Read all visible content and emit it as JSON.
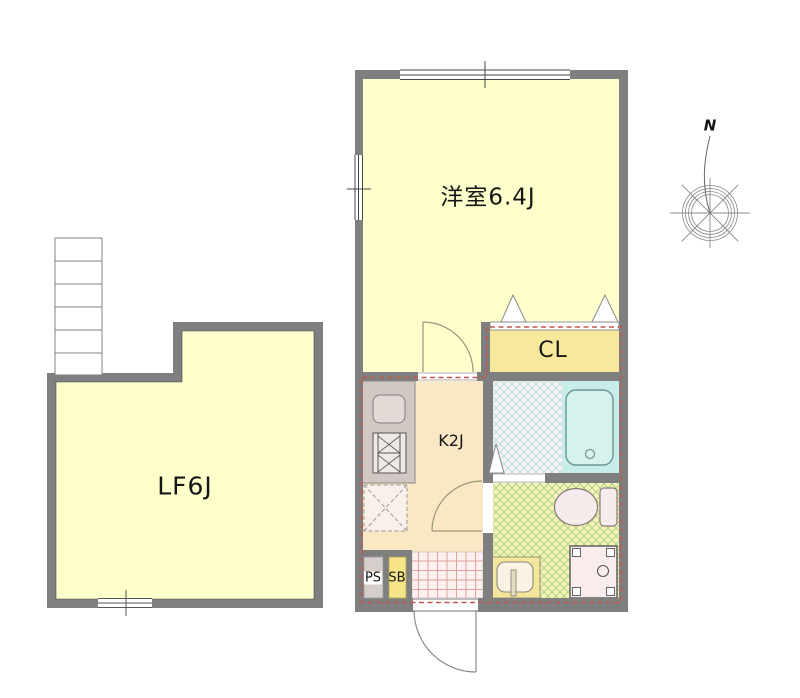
{
  "plan": {
    "rooms": {
      "western_room": "洋室6.4J",
      "loft": "LF6J",
      "closet": "CL",
      "kitchen": "K2J",
      "pipe_space": "PS",
      "shoe_box": "SB"
    },
    "compass_north": "N",
    "colors": {
      "wall": "#7F7F7F",
      "room_floor": "#FFFFCC",
      "closet_floor": "#F8E89B",
      "kitchen_floor": "#FAE7C4",
      "bath_hatch_line": "#A9DBDE",
      "bathtub_area": "#C8EDE8",
      "washroom_hatch_line": "#A9CF74",
      "entry_tile_line": "#DFA49C",
      "boundary_dash": "#C2574E"
    }
  }
}
